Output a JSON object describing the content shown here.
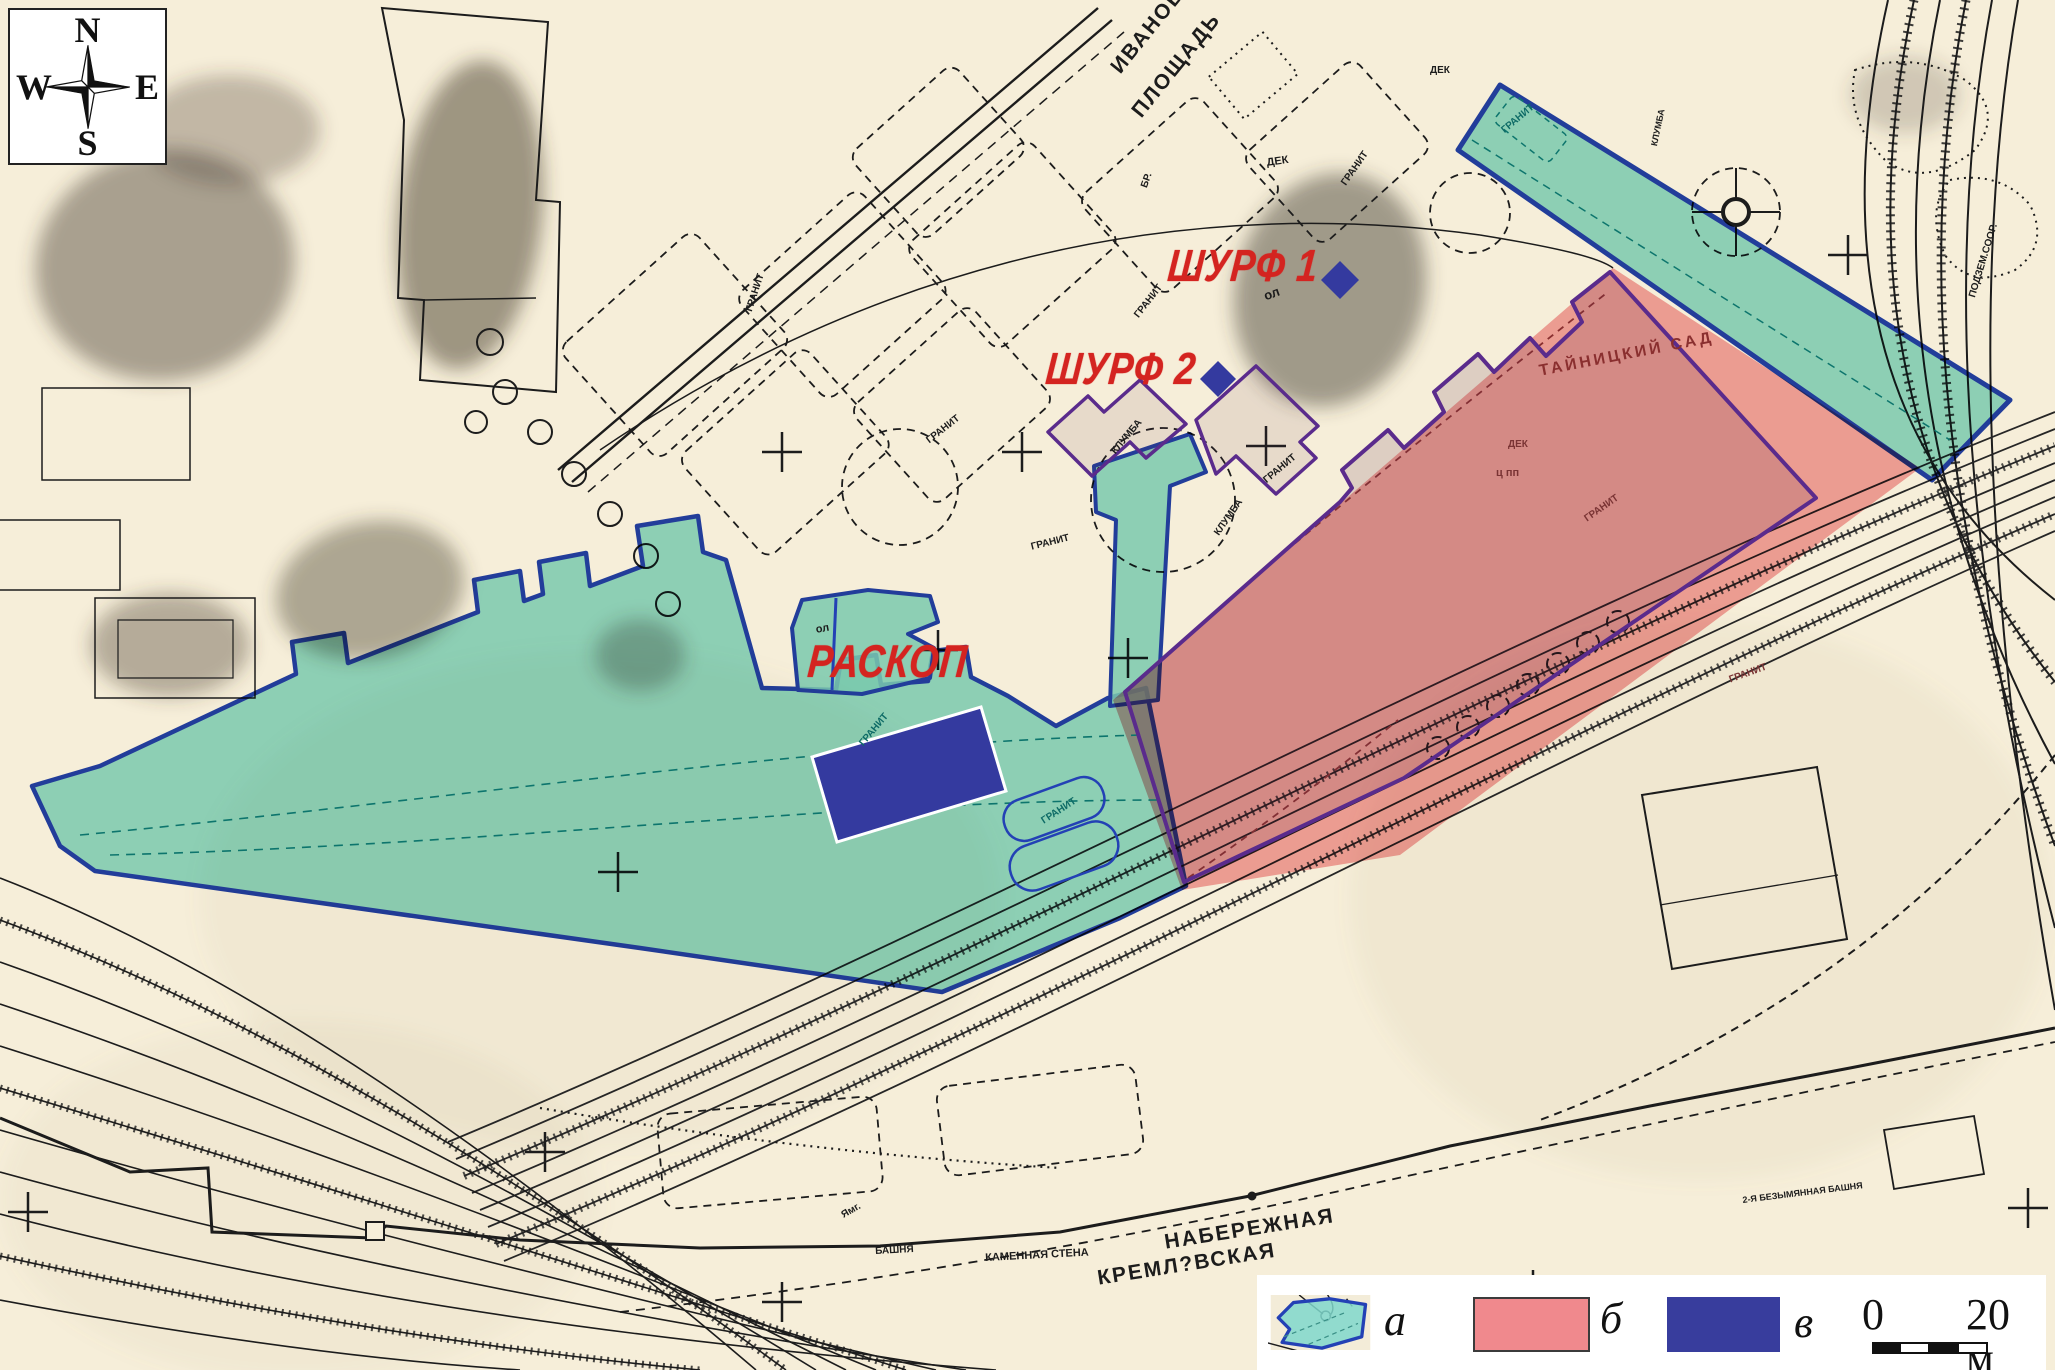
{
  "compass": {
    "n": "N",
    "s": "S",
    "w": "W",
    "e": "E"
  },
  "annotations": {
    "excavation": "РАСКОП",
    "pit1": "ШУРФ 1",
    "pit2": "ШУРФ 2"
  },
  "legend": {
    "item_a": "а",
    "item_b": "б",
    "item_v": "в",
    "scale_start": "0",
    "scale_end": "20 м"
  },
  "colors": {
    "zone_a_fill": "#7fd8cd",
    "zone_a_border": "#2341b5",
    "zone_b_fill": "#f0898d",
    "zone_v_fill": "#343a9f",
    "observation_border": "#5a2b8c",
    "label_red": "#d42420",
    "paper": "#f6eed9"
  },
  "map_labels": [
    {
      "t": "ИВАНОВСКАЯ",
      "x": 1107,
      "y": 64,
      "r": -51,
      "s": 21,
      "ls": 2
    },
    {
      "t": "ПЛОЩАДЬ",
      "x": 1128,
      "y": 108,
      "r": -51,
      "s": 21,
      "ls": 2
    },
    {
      "t": "КРЕМЛ?ВСКАЯ",
      "x": 1096,
      "y": 1268,
      "r": -9,
      "s": 21,
      "ls": 2
    },
    {
      "t": "НАБЕРЕЖНАЯ",
      "x": 1163,
      "y": 1232,
      "r": -9,
      "s": 21,
      "ls": 2
    },
    {
      "t": "КАМЕННАЯ СТЕНА",
      "x": 985,
      "y": 1253,
      "r": -3,
      "s": 11
    },
    {
      "t": "БАШНЯ",
      "x": 875,
      "y": 1247,
      "r": -3,
      "s": 10
    },
    {
      "t": "Ямг.",
      "x": 840,
      "y": 1212,
      "r": -30,
      "s": 10
    },
    {
      "t": "2-Я БЕЗЫМЯННАЯ БАШНЯ",
      "x": 1742,
      "y": 1196,
      "r": -7,
      "s": 9
    },
    {
      "t": "ТАЙНИЦКИЙ САД",
      "x": 1538,
      "y": 364,
      "r": -11,
      "s": 16,
      "c": "#8a2f2f",
      "ls": 3
    },
    {
      "t": "ПОДЗЕМ.СООР.",
      "x": 1968,
      "y": 296,
      "r": -73,
      "s": 10
    },
    {
      "t": "ГРАНИТ",
      "x": 745,
      "y": 310,
      "r": -72,
      "s": 10
    },
    {
      "t": "ГРАНИТ",
      "x": 925,
      "y": 438,
      "r": -38,
      "s": 10
    },
    {
      "t": "ГРАНИТ",
      "x": 1030,
      "y": 543,
      "r": -14,
      "s": 10
    },
    {
      "t": "ГРАНИТ",
      "x": 1133,
      "y": 314,
      "r": -52,
      "s": 10
    },
    {
      "t": "ГРАНИТ",
      "x": 1340,
      "y": 182,
      "r": -55,
      "s": 10
    },
    {
      "t": "ГРАНИТ",
      "x": 1262,
      "y": 478,
      "r": -40,
      "s": 10
    },
    {
      "t": "ГРАНИТ",
      "x": 1500,
      "y": 128,
      "r": -40,
      "s": 10,
      "c": "#0e6b66"
    },
    {
      "t": "ГРАНИТ",
      "x": 1583,
      "y": 516,
      "r": -35,
      "s": 10,
      "c": "#7a3434"
    },
    {
      "t": "ГРАНИТ",
      "x": 1728,
      "y": 676,
      "r": -20,
      "s": 10,
      "c": "#7a3434"
    },
    {
      "t": "ГРАНИТ",
      "x": 858,
      "y": 742,
      "r": -50,
      "s": 10,
      "c": "#0e6b66"
    },
    {
      "t": "ГРАНИТ",
      "x": 1040,
      "y": 818,
      "r": -33,
      "s": 10,
      "c": "#0e6b66"
    },
    {
      "t": "КЛУМБА",
      "x": 1110,
      "y": 450,
      "r": -50,
      "s": 10
    },
    {
      "t": "КЛУМБА",
      "x": 1213,
      "y": 532,
      "r": -55,
      "s": 10
    },
    {
      "t": "КЛУМБА",
      "x": 1650,
      "y": 145,
      "r": -78,
      "s": 9
    },
    {
      "t": "ДЕК",
      "x": 1266,
      "y": 158,
      "r": -8,
      "s": 11
    },
    {
      "t": "ДЕК",
      "x": 1430,
      "y": 66,
      "r": 0,
      "s": 10
    },
    {
      "t": "ДЕК",
      "x": 1508,
      "y": 440,
      "r": 0,
      "s": 10,
      "c": "#7a3434"
    },
    {
      "t": "ц пп",
      "x": 1496,
      "y": 468,
      "r": 0,
      "s": 11,
      "c": "#7a3434"
    },
    {
      "t": "ол",
      "x": 1262,
      "y": 290,
      "r": -20,
      "s": 13
    },
    {
      "t": "ол",
      "x": 815,
      "y": 625,
      "r": -10,
      "s": 11
    },
    {
      "t": "БР.",
      "x": 1140,
      "y": 186,
      "r": -70,
      "s": 10
    }
  ]
}
